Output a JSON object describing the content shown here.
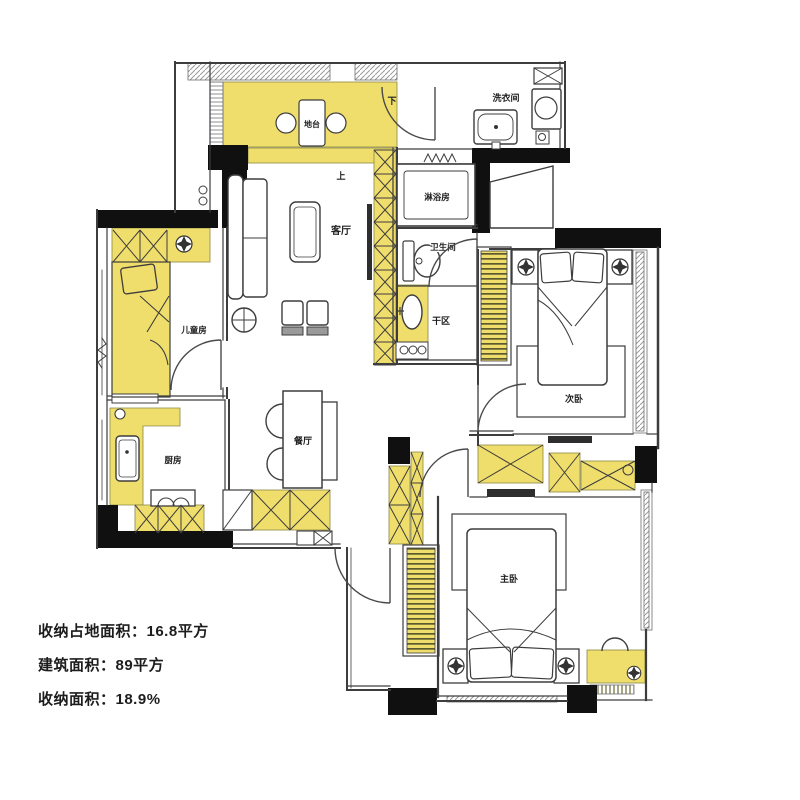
{
  "palette": {
    "accent_yellow": "#F0DE6C",
    "wall_black": "#101010",
    "line_gray": "#3d3d3d"
  },
  "stats": {
    "lines": [
      "收纳占地面积：16.8平方",
      "建筑面积：89平方",
      "收纳面积：18.9%"
    ]
  },
  "rooms": {
    "platform": {
      "label": "地台"
    },
    "living": {
      "label": "客厅"
    },
    "laundry": {
      "label": "洗衣间"
    },
    "shower": {
      "label": "淋浴房"
    },
    "bathroom": {
      "label": "卫生间"
    },
    "dry_area": {
      "label": "干区"
    },
    "kids": {
      "label": "儿童房"
    },
    "kitchen": {
      "label": "厨房"
    },
    "dining": {
      "label": "餐厅"
    },
    "bedroom2": {
      "label": "次卧"
    },
    "master": {
      "label": "主卧"
    }
  },
  "markers": {
    "up": "上",
    "down": "下"
  }
}
